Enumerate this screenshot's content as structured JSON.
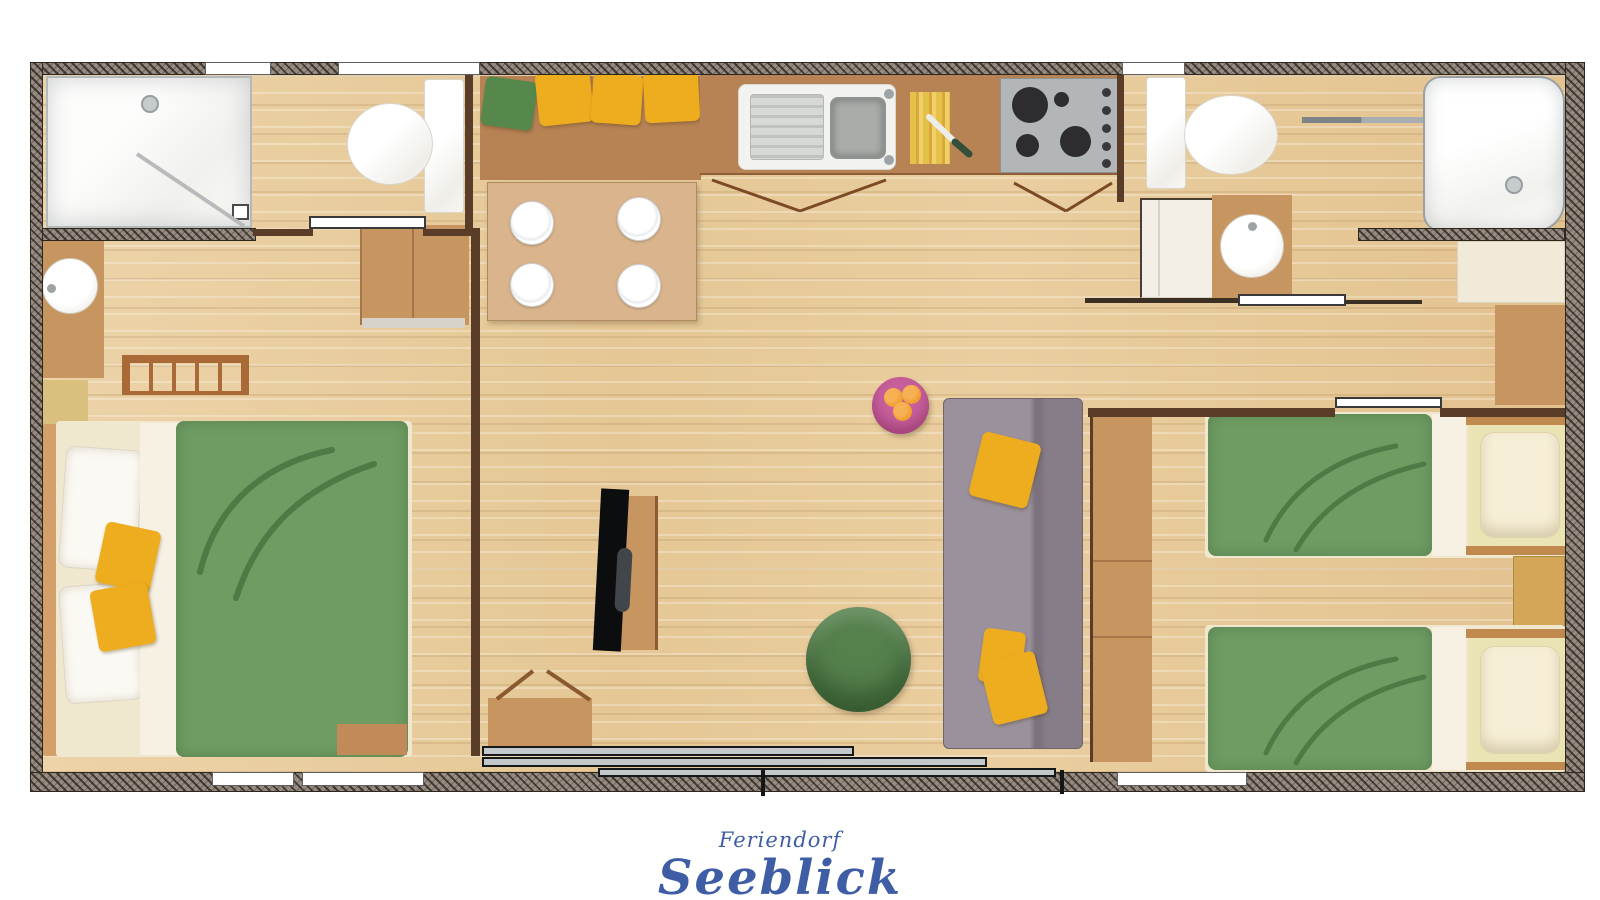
{
  "branding": {
    "line1": "Feriendorf",
    "line2": "Seeblick",
    "color": "#3e5da5"
  },
  "palette": {
    "wood_floor": "#e8cc9d",
    "exterior_wall": "#968c82",
    "interior_wall": "#5a3d28",
    "counter_brown": "#b78355",
    "table_tan": "#d9b48c",
    "cabinet_tan": "#c79560",
    "khaki_box": "#d9c07f",
    "sideboard_brown": "#c18a58",
    "nightstand_tan": "#d4a758",
    "headboard_khaki": "#eae3b4",
    "duvet_green": "#6f9c63",
    "duvet_line_green": "#4d7a45",
    "cushion_yellow": "#eead1e",
    "cushion_green": "#55884a",
    "sofa_gray": "#8f8591",
    "pouf_green": "#55814d",
    "side_table_pink": "#c75f9c",
    "orange_fruit": "#ef9b28",
    "porcelain_white": "#fbfbfa"
  },
  "plan": {
    "type": "holiday-home floor plan, top-down view",
    "rooms": [
      {
        "name": "bathroom-left",
        "fixtures": [
          "shower with glass door",
          "toilet",
          "sliding door"
        ]
      },
      {
        "name": "bedroom-left",
        "fixtures": [
          "double bed with green duvet",
          "two white pillows",
          "two yellow cushions",
          "washbasin counter",
          "radiator",
          "sideboard"
        ]
      },
      {
        "name": "kitchen-dining",
        "fixtures": [
          "bench with one green and three yellow cushions",
          "dining table with four plates",
          "sink unit with drainer",
          "cutting board with knife",
          "four-burner hob",
          "cabinet door swing marks"
        ]
      },
      {
        "name": "living-room",
        "fixtures": [
          "tv on stand",
          "tv cabinet with open doors",
          "gray sofa with yellow cushions",
          "green pouf",
          "pink side table with oranges",
          "sliding patio door"
        ]
      },
      {
        "name": "bathroom-right",
        "fixtures": [
          "toilet",
          "white cabinet",
          "washbasin vanity",
          "bathtub",
          "towel rail",
          "sliding door"
        ]
      },
      {
        "name": "bedroom-right",
        "fixtures": [
          "two single beds with green duvets",
          "cream pillows",
          "nightstand",
          "wardrobe",
          "sliding door"
        ]
      }
    ]
  }
}
